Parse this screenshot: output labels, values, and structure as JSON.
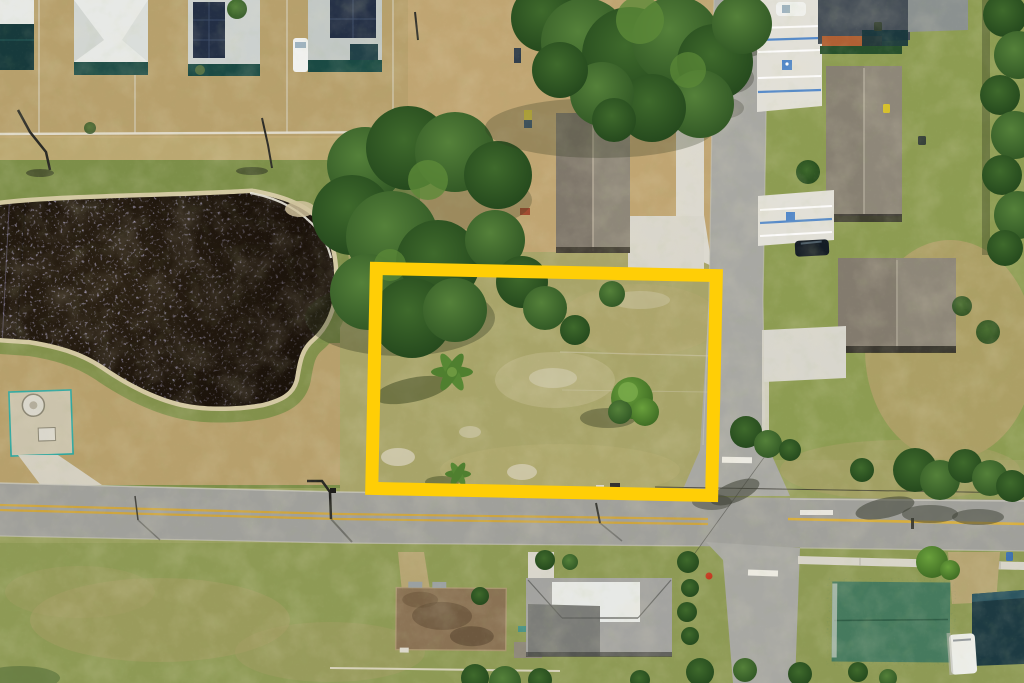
{
  "image": {
    "description": "Aerial drone photo of a vacant corner lot highlighted with a thick yellow rectangle, beside a dark retention pond with sun glint, at the intersection of two residential streets with houses, driveways and trees around it",
    "width": 1024,
    "height": 683
  },
  "colors": {
    "grassBase": "#98a05e",
    "grassBright": "#86974e",
    "grassEast": "#8d9c52",
    "dirtTan": "#b7a06c",
    "dirtCenter": "#c0a572",
    "lotGrass": "#a8a469",
    "pondWater": "#211910",
    "pondSparkle": "#9a93d6",
    "sandRim": "#d7cba6",
    "greenFringe": "#7d8f49",
    "roadAsphalt": "#a0a09b",
    "roadLight": "#a8a8a3",
    "laneYellow": "#cda43e",
    "markingWhite": "#eceae2",
    "concrete": "#e2e0d8",
    "sidewalk": "#d7d4c9",
    "roofWhite": "#e7e9e6",
    "roofGray": "#c7cdca",
    "roofBrownGray": "#8e8779",
    "roofFlatBrown": "#8a7254",
    "roofGreen": "#467a5e",
    "roofTeal": "#1d3a42",
    "roofDarkNavy": "#454e57",
    "solarPanel": "#232f45",
    "wallTeal": "#1a4a44",
    "wallOrange": "#b06034",
    "parkingBlue": "#4f86c9",
    "treeDark": "#2c5222",
    "treeMid": "#4c7a33",
    "bushGreen": "#5f9036",
    "shadow": "#313a20",
    "highlightYellow": "#ffce06",
    "hydrantRed": "#c43b22",
    "vanWhite": "#f0f1ef",
    "carDark": "#141c24"
  },
  "scene": {
    "features": [
      {
        "name": "highlighted-parcel",
        "kind": "yellow boundary overlay"
      },
      {
        "name": "retention-pond",
        "kind": "water body with sun glint"
      },
      {
        "name": "horizontal-street",
        "kind": "east-west road, double yellow centerline"
      },
      {
        "name": "vertical-street",
        "kind": "north-south road through intersection"
      },
      {
        "name": "top-left-neighborhood",
        "kind": "houses with white roofs and solar panels"
      },
      {
        "name": "east-side-houses",
        "kind": "houses with gray-brown roofs and striped driveways"
      },
      {
        "name": "south-side-houses",
        "kind": "houses with brown, gray, green and teal roofs"
      },
      {
        "name": "utility-pad",
        "kind": "fenced lift station near pond"
      },
      {
        "name": "tree-canopies",
        "kind": "oak and palm trees with cast shadows"
      }
    ]
  }
}
